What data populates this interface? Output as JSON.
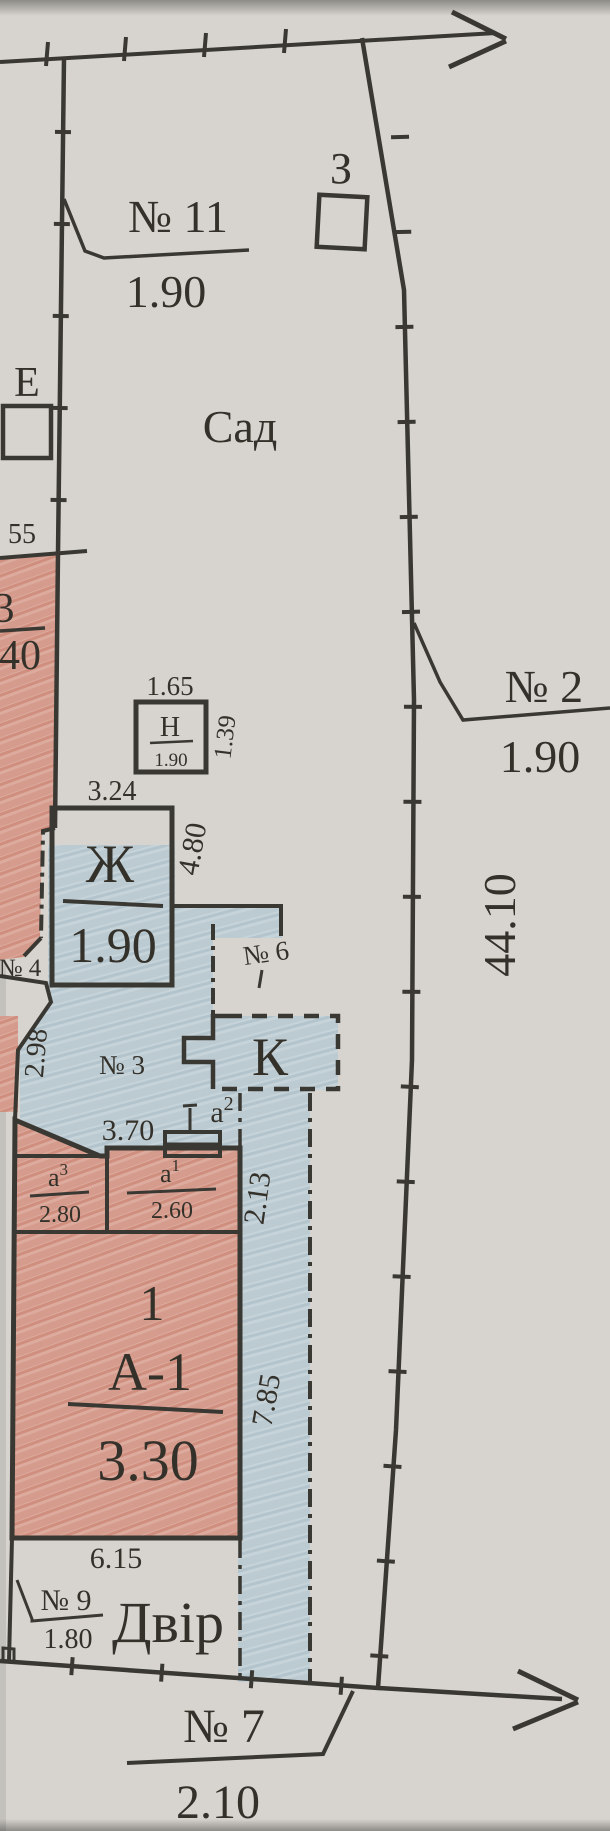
{
  "plan": {
    "parcels": {
      "no11": {
        "label": "№ 11",
        "value": "1.90"
      },
      "no2": {
        "label": "№ 2",
        "value": "1.90"
      },
      "no7": {
        "label": "№ 7",
        "value": "2.10"
      },
      "no9": {
        "label": "№ 9",
        "value": "1.80"
      }
    },
    "areas": {
      "garden": "Сад",
      "yard": "Двір"
    },
    "markers": {
      "z": "З",
      "e": "Е"
    },
    "buildings": {
      "main": {
        "number": "1",
        "code": "А-1",
        "value": "3.30"
      },
      "zh": {
        "code": "Ж",
        "value": "1.90"
      },
      "n": {
        "code": "Н",
        "value": "1.90"
      },
      "k": {
        "code": "К"
      },
      "a1": {
        "base": "а",
        "sup": "1",
        "value": "2.60"
      },
      "a3": {
        "base": "а",
        "sup": "3",
        "value": "2.80"
      },
      "a2": {
        "base": "а",
        "sup": "2"
      }
    },
    "rooms": {
      "no3": "№ 3",
      "no4": "№ 4",
      "no6": "№ 6"
    },
    "edge_fragment": {
      "tick": "55",
      "frac_top": "3",
      "frac_bottom": "40"
    },
    "dimensions": {
      "boundary_right": "44.10",
      "n_width": "1.65",
      "n_side": "1.39",
      "zh_width": "3.24",
      "zh_side": "4.80",
      "left_side": "2.98",
      "porch_width": "3.70",
      "strip_top": "2.13",
      "strip_side": "7.85",
      "yard_width": "6.15"
    },
    "colors": {
      "ink": "#3a3833",
      "paper": "#d7d4cf",
      "building_fill": "#dcab9e",
      "wood_fill": "#e6d34f",
      "passage_fill": "#c6d3d9"
    }
  }
}
